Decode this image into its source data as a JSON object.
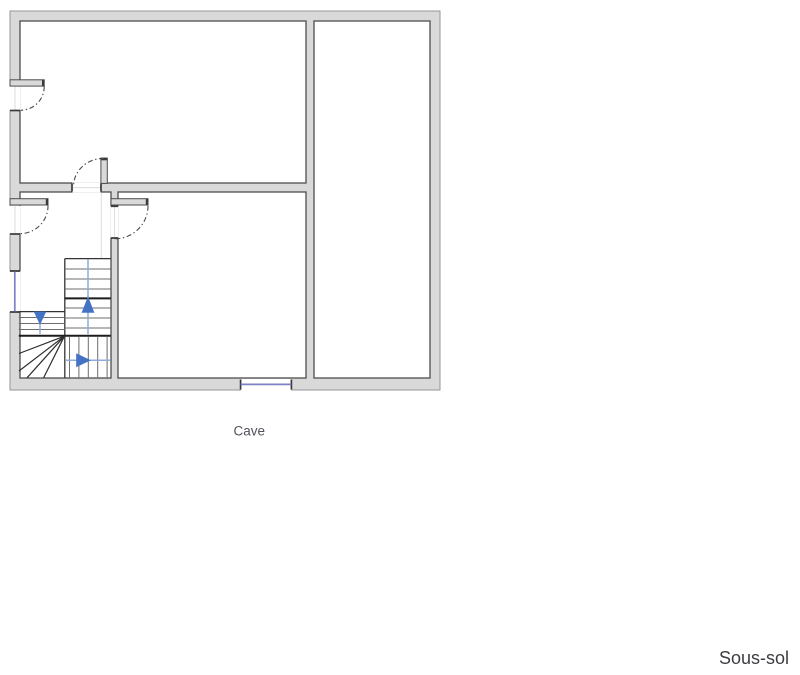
{
  "floor_plan": {
    "floor_label": "Sous-sol",
    "rooms": [
      {
        "label": "Cave"
      }
    ],
    "stairs": {
      "arrows": [
        "down",
        "up",
        "right"
      ]
    }
  },
  "colors": {
    "wall_fill": "#d9d9d9",
    "slab_stroke": "#969696",
    "room_stroke": "#4d4d4d",
    "cap_color": "#3a3a3a",
    "arc_color": "#4a4a4a",
    "tread_color": "#6e6e6e",
    "stair_dark": "#1c1c1c",
    "arrow_head": "#4472c4",
    "arrow_stem": "#8fabdc",
    "window_color": "#7d82c6",
    "room_label_color": "#53535c",
    "floor_label_color": "#3c3c42",
    "faint_line": "#dcdcdc"
  }
}
